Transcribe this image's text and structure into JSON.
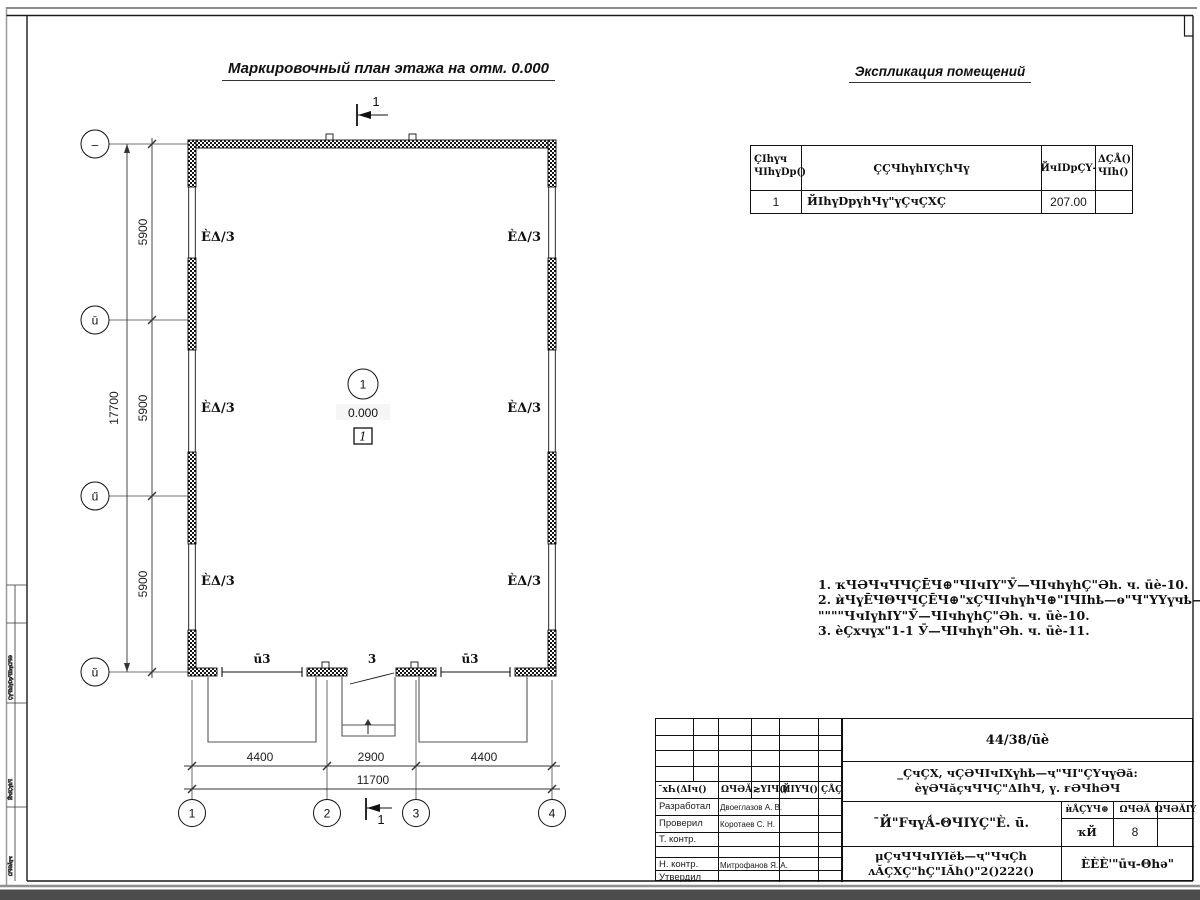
{
  "titles": {
    "plan": "Маркировочный план этажа на отм. 0.000",
    "explication": "Экспликация помещений"
  },
  "table": {
    "h_num1": "ҪIһүч",
    "h_num2": "ЧIһүDр()",
    "h_name": "ҪҪЧһүһIҮҪһЧү",
    "h_area": "ЙчIDрҪҮ-",
    "h_cat1": "ΔҪÅ()",
    "h_cat2": "ЧIһ()",
    "r_num": "1",
    "r_name": "ЙIһүDрүһЧү\"үҪчҪХҪ",
    "r_area": "207.00",
    "r_cat": ""
  },
  "notes": {
    "l1": "1. ҡЧӘЧчЧЧҪĒЧ⊕\"ЧIчIҮ\"Ӯ—ЧIчһүһҪ\"Әһ. ч. ūè-10.",
    "l2": "2. ѝЧүĒЧΘЧЧҪĒЧ⊕\"хҪЧIчһүһЧ⊕\"IЧIһҍ—ѳ\"Ч\"ҮҮүчҍ—ѳ",
    "l3": "\"\"\"\"ЧчIүһIҮ\"Ӯ—ЧIчһүһҪ\"Әһ. ч. ūè-10.",
    "l4": "3. ѐҪхчүх\"1-1 Ӯ—ЧIчһүһ\"Әһ. ч. ūè-11."
  },
  "plan": {
    "grid": {
      "r1": "–",
      "r2": "ū",
      "r3": "ű",
      "r4": "ŭ",
      "c1": "1",
      "c2": "2",
      "c3": "3",
      "c4": "4"
    },
    "dims": {
      "seg_v": "5900",
      "total_v": "17700",
      "seg_h1": "4400",
      "seg_h2": "2900",
      "seg_h3": "4400",
      "total_h": "11700"
    },
    "marks": {
      "room": "ÈΔ/3",
      "level": "0.000",
      "room_num": "1",
      "node": "1",
      "section": "1"
    },
    "doors": {
      "left": "ū3",
      "mid": "3",
      "right": "ū3"
    }
  },
  "stamp": {
    "doc_number": "44/38/ūè",
    "project_line1": "_ҪчҪХ, чҪӘЧIчIХүһҍ—ҷ\"ЧI\"ҪҮчүӘă:",
    "project_line2": "ѐүӘЧăҫчЧЧҪ\"ΔIһЧ, ү. ғӘЧһӘЧ",
    "hdr1": "¯хҺ(ΔIч()",
    "hdr2": "ΩЧӘĂ",
    "hdr3": "≳ҮIЧ()",
    "hdr4": "ЙIҮЧ()",
    "hdr5": "ҪÅҪ",
    "roles": [
      {
        "label": "Разработал",
        "name": "Двоеглазов А. В."
      },
      {
        "label": "Проверил",
        "name": "Коротаев С. Н."
      },
      {
        "label": "Т. контр.",
        "name": ""
      },
      {
        "label": "",
        "name": ""
      },
      {
        "label": "Н. контр.",
        "name": "Митрофанов Я. А."
      },
      {
        "label": "Утвердил",
        "name": ""
      }
    ],
    "sheet_title": "¯Й\"FчүǺ-ΘЧIҮҪ\"È. ū.",
    "stage_h1": "ѝÅҪҮЧ⊕",
    "stage_h2": "ΩЧӘĂ",
    "stage_h3": "ΩЧӘĂIҮ",
    "stage_v1": "ҡЙ",
    "stage_v2": "8",
    "stage_v3": "",
    "bottom_line1": "μҪчЧЧчIҮIĕҍ—ҷ\"ЧчҪһ",
    "bottom_line2": "ʌĂҪХҪ\"һҪ\"IĂһ()\"2()222()",
    "org": "ÈÈÈ'\"ūч-Θһә\""
  },
  "side": {
    "b1": "ҪүЧһIүDрЧIһүΩЧӘ",
    "b2": "ЙчIҪүһЧ",
    "b3": "ΩЧӘĂүч"
  }
}
